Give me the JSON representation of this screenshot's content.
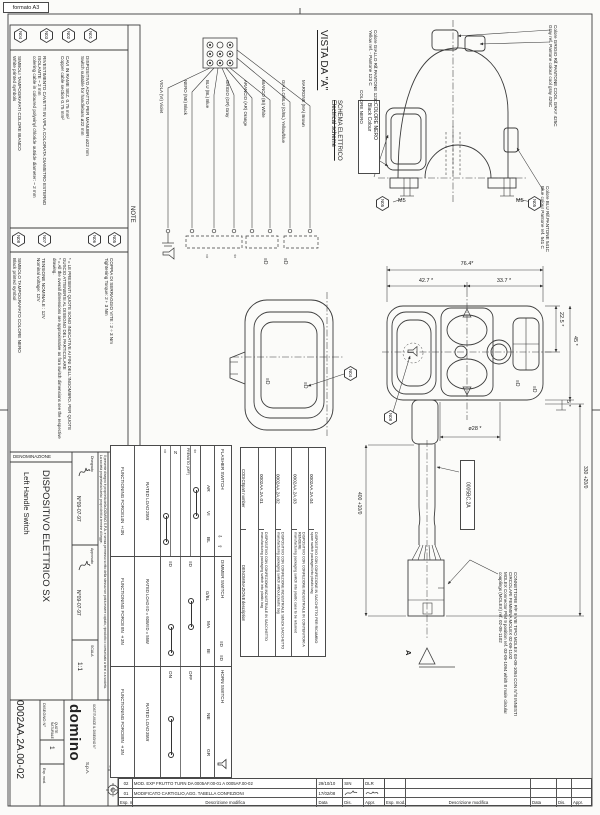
{
  "misc": {
    "format": "formato A3",
    "a": "A",
    "tag": "0005BC.2A"
  },
  "ic": {
    "al": "⇦",
    "ar": "⇨",
    "au": "⇧",
    "ad": "⇩",
    "beam": "≡D"
  },
  "n": {
    "title": "NOTE",
    "items": [
      {
        "id": "N01",
        "it": "DISPOSITIVO ADATTO PER MANUBRI ø22 mm",
        "en": "Switch suitable for handlebars ø22 mm"
      },
      {
        "id": "N02",
        "it": "CAVI IN RAME SEZ. 0.75 mm²",
        "en": "Copper cable section 0.75 mm²"
      },
      {
        "id": "N03",
        "it": "RIVESTIMENTO CAVETTI IN VIPLA COLORATA DIAMETRO ESTERNO ISOLANTE ~ 2 mm",
        "en": "colering cable in coloured polyvinyl chloride outside diameter: ~ 2 mm"
      },
      {
        "id": "N04",
        "it": "SIMBOLI TAMPOGRAFATI COLORE BIANCO",
        "en": "White printed symbols"
      },
      {
        "id": "N05",
        "it": "COPPIA DI SERRAGGIO VITE : 2÷3 Nm",
        "en": "Tightening Torque: 2÷3 Nm"
      },
      {
        "id": "N06",
        "it": "* = LE PRESENTI QUOTE SONO INDICATIVE AI FINI DELL'INGOMBRO. PER QUOTE GUSCIO ATTENERSI AL DISEGNO DEL PARTICOLARE",
        "en": "* = All the overall dimensions are approximative as fora switch dimensions see the respective drawing."
      },
      {
        "id": "N07",
        "it": "TENSIONE NOMINALE : 12V",
        "en": "Nominal voltage: 12V"
      },
      {
        "id": "N08",
        "it": "SIMBOLO TAMPOGRAFATO COLORE NERO",
        "en": "Black printed symbol"
      }
    ]
  },
  "sch": {
    "view": "VISTA DA \"A\"",
    "t1": "SCHEMA ELETTRICO",
    "t2": "Electrical scheme",
    "c1": "COLORE NERO",
    "c2": "Black Colour",
    "wires": [
      "VIOLA (VI)  Violet",
      "NERO (NE)  Black",
      "BLU (BL)  Blue",
      "GRIGIO (GR)  Gray",
      "ARANCIO (AR)  Orange",
      "BIANCO (BI)  White",
      "GIALLO/BLU (G/BL)  Yellow/blue",
      "MARRONE (MA)  Brown"
    ]
  },
  "co": {
    "y1": "Colore GIALLO Rif.PANTONE 123C",
    "y2": "Yellow ref. - Pantone 123 C",
    "k": "COLORE NERO",
    "g1": "Colore GRIGIO Rif.PANTONE COOL GRAY 425C",
    "g2": "Gray ref. Pantone colour cool gray 425C",
    "b1": "Colore BLU Rif.PANTONE 541C",
    "b2": "Blue colour Pantone ref. 541 C",
    "m5": "M5"
  },
  "dim": {
    "w": "76.4*",
    "w1": "42.7 *",
    "w2": "33.7 *",
    "h1": "22.5 *",
    "h2": "45 *",
    "h3": "5 *",
    "dia": "ø28 *",
    "len": "400 +10/0",
    "len2": "330 +20/0"
  },
  "tf": {
    "name": "FLASHER SWITCH",
    "wires": [
      "AR",
      "VI",
      "BL"
    ],
    "s": [
      {
        "l": "⇩"
      },
      {
        "l": "N"
      },
      {
        "l": "PREMUTO (OFF)"
      },
      {
        "l": "⇧"
      }
    ],
    "rl": "RATED LOAD",
    "rv": "25W",
    "fl": "FUNCTIONING FORCE",
    "fv": "14N ±3N"
  },
  "td": {
    "name": "DIMMER SWITCH",
    "wires": [
      "G/BL",
      "MA",
      "BI"
    ],
    "s": [
      {
        "l": "≡D"
      },
      {
        "l": "≡D"
      }
    ],
    "rl": "RATED LOAD",
    "r1": "≡D = 60W",
    "r2": "≡D = 55W",
    "fl": "FUNCTIONING FORCE",
    "fv": "8N ±3N"
  },
  "th": {
    "name": "HORN SWITCH",
    "wires": [
      "NE",
      "GR"
    ],
    "s": [
      {
        "l": "ON"
      },
      {
        "l": "OFF"
      }
    ],
    "rl": "RATED LOAD",
    "rv": "35W",
    "fl": "FUNCTIONING FORCE",
    "fv": "8N ±3N"
  },
  "pt": {
    "c1": "CODICE",
    "c2": "part number",
    "d1": "DENOMINAZIONE",
    "d2": "description",
    "rows": [
      {
        "c": "0002AA.2A.01",
        "it": "DISPOSITIVO CON CONFEZIONE INDUSTRIALE IN SACCHETTO",
        "en": "manufacturing packaging switch into plastic bag"
      },
      {
        "c": "0002AA.2A.02",
        "it": "DISPOSITIVO CON CONFEZIONE INDUSTRIALE SENZA SACCHETTO",
        "en": "manufacturing packaging switch without plastic bag"
      },
      {
        "c": "0002AA.2A.03",
        "it": "DISPOSITIVO CON CONFEZIONE INDUSTRIALE IN CONTENITORI A RENDERE",
        "en": "manufacturing packaging switch into plastic case to be returned"
      },
      {
        "c": "0002AA.2A.04",
        "it": "DISPOSITIVO CON CONFEZIONE IN SACCHETTO PER RICAMBIO",
        "en": "spare switch packaged into plastic bag"
      }
    ]
  },
  "cn": {
    "it": "CONNETTORE P/F 9 VIE TIPO MOLEX 03-09-1094  CON N°8 INNESTI CIRCOLARI FEMMINA MOLEX 02-09-1102",
    "en": "MOLEX Connector P/M 9 position ref. 03-09-1094 whith 8 male circular couplings (MOLEX) ref. 02-09-1102"
  },
  "tb": {
    "denom": "DENOMINAZIONE",
    "name_it": "DISPOSITIVO ELETTRICO SX",
    "name_en": "Left Handle Switch",
    "drawn": "Disegnato",
    "appr": "Approvato",
    "date1": "N°09-07-97",
    "date2": "N°09-07-97",
    "scala": "SCALA",
    "scale": "1:1",
    "dwg_label": "DISEGNO N°",
    "dwg_no": "0002AA.2A.00-02",
    "esp": "Esp. mod.",
    "one": "1",
    "quote": "QUOTE NATURALE",
    "replaces": "SOSTITUISCE IL DISEGNO N°",
    "co": "domino",
    "co2": "S.p.A.",
    "prop1": "Il presente disegno è proprietà della DOMINO S.P.A. e senza permesso scritto della stessa non potrà essere copiato, riprodotto o comunicato a terzi o a società.",
    "prop2": "La società proprietaria tutela i propri diritti a termine di legge."
  },
  "rv": {
    "r2": {
      "e": "02",
      "d": "MOD. EXP FRUTTO TURN DA 0005AF.00-01 A 0005AF.00-02",
      "dt": "29/10/10",
      "ds": "SIN",
      "ap": "DLR"
    },
    "r1": {
      "e": "01",
      "d": "MODIFICATO CARTIGLIO,AGG. TABELLA CONFEZIONI",
      "dt": "17/02/08",
      "ds": "",
      "ap": ""
    },
    "f": {
      "e": "Esp. mod.",
      "d": "Descrizione modifica",
      "dt": "Data",
      "ds": "Dis.",
      "ap": "Appr."
    }
  }
}
